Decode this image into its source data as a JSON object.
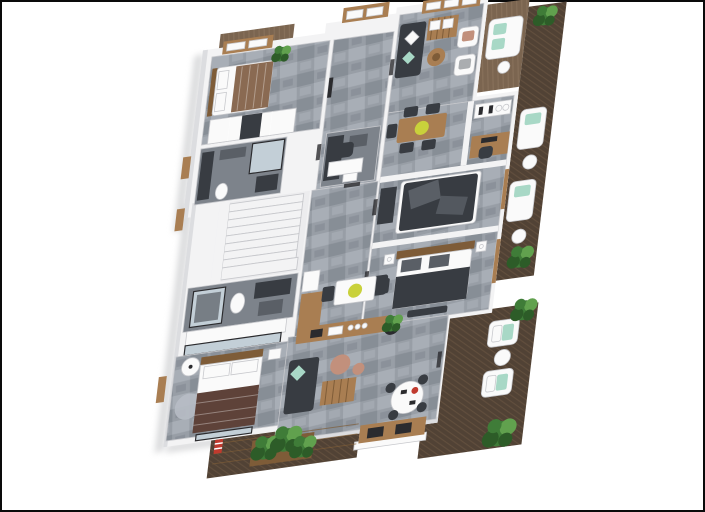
{
  "scene": {
    "title": "3D rendered apartment floor plan, top-down isometric view on white background with thin dark frame",
    "rooms": [
      {
        "name": "bedroom-top-left",
        "furniture": [
          "double-bed-brown-bedding",
          "wardrobe",
          "plant",
          "wood-frame-window"
        ]
      },
      {
        "name": "bathroom-top-left",
        "furniture": [
          "vanity",
          "toilet",
          "shower-glass",
          "washer"
        ]
      },
      {
        "name": "entry-hall",
        "furniture": [
          "wood-frame-entry-door",
          "wall-tv-panel",
          "desk",
          "office-chair"
        ]
      },
      {
        "name": "lounge-top-right",
        "furniture": [
          "dark-sofa",
          "wood-slat-daybed",
          "two-armchairs",
          "round-coffee-table",
          "wood-frame-windows"
        ]
      },
      {
        "name": "dining-area",
        "furniture": [
          "wood-table",
          "five-dark-chairs",
          "yellow-bowl"
        ]
      },
      {
        "name": "home-office",
        "furniture": [
          "shelf-with-bottles",
          "wood-desk",
          "monitor",
          "office-chair"
        ]
      },
      {
        "name": "bedroom-right-middle",
        "furniture": [
          "double-bed-dark-blanket",
          "dark-dresser"
        ]
      },
      {
        "name": "bedroom-right-lower",
        "furniture": [
          "double-bed-with-headboard",
          "nightstands-with-lamps",
          "bench",
          "dark-armchair"
        ]
      },
      {
        "name": "wc-center",
        "furniture": [
          "vanity",
          "washer",
          "sink"
        ]
      },
      {
        "name": "staircase",
        "furniture": [
          "white-steps"
        ]
      },
      {
        "name": "bathroom-lower-left",
        "furniture": [
          "shower-glass",
          "toilet",
          "dark-vanity",
          "cabinet-row",
          "glass-partition"
        ]
      },
      {
        "name": "master-bedroom",
        "furniture": [
          "double-bed-maroon-blanket",
          "floor-lamp",
          "round-rug",
          "nightstand",
          "glass-door"
        ]
      },
      {
        "name": "kitchen",
        "furniture": [
          "fridge",
          "l-shaped-wood-counter",
          "sink",
          "cooktop",
          "white-breakfast-table",
          "yellow-bowl",
          "two-dark-chairs",
          "potted-plant"
        ]
      },
      {
        "name": "living-room-bottom",
        "furniture": [
          "dark-sofa-mint-pillow",
          "wood-slat-coffee-table",
          "terracotta-side-tables",
          "round-white-dining-table",
          "dark-chairs",
          "red-teapot"
        ]
      },
      {
        "name": "terrace-bottom-right",
        "furniture": [
          "herringbone-deck",
          "two-white-armchairs-mint-pillows",
          "round-side-table",
          "outdoor-wood-counter-with-grills",
          "plants"
        ]
      },
      {
        "name": "side-balcony-right",
        "furniture": [
          "deck",
          "two-loungers-mint-pillows",
          "round-tables",
          "plants"
        ]
      },
      {
        "name": "upper-balcony-right",
        "furniture": [
          "light-deck",
          "white-sofa-mint-pillows",
          "round-table"
        ]
      },
      {
        "name": "master-balcony-bottom-left",
        "furniture": [
          "herringbone-deck",
          "pergola-beams",
          "planter-box",
          "red-striped-towel"
        ]
      },
      {
        "name": "bedroom-top-left-mini-deck",
        "furniture": [
          "light-deck",
          "plant"
        ]
      }
    ]
  },
  "colors": {
    "background": "#ffffff",
    "border": "#0a0a0a",
    "wall": "#f3f3f4",
    "wall_shade": "#dcdde0",
    "wall_edge": "#c7c8cc",
    "floor_tile": "#989ea6",
    "floor_tile_light": "#b7bdc5",
    "floor_tile_dark": "#6f757d",
    "floor_bath": "#7d838b",
    "stairs": "#ececee",
    "deck_dark": "#514235",
    "deck_line": "#665340",
    "deck_light": "#7b6550",
    "deck_light_line": "#8f7861",
    "wood": "#a97e52",
    "wood_dark": "#7e5c38",
    "white_furn": "#fafafa",
    "furn_dark": "#383c42",
    "furn_mid": "#5a5f66",
    "mint": "#a8d8c6",
    "yellow": "#c9d13b",
    "terracotta": "#c2907c",
    "maroon": "#5e4239",
    "bed_brown": "#8a6a52",
    "glass": "#c3cfd7",
    "frame_dark": "#2b2b2e",
    "red": "#c03a2e",
    "plant": "#3f7c38",
    "plant_dark": "#2d5c28",
    "plant_light": "#61a14e",
    "shadow": "#bcbdc0"
  }
}
